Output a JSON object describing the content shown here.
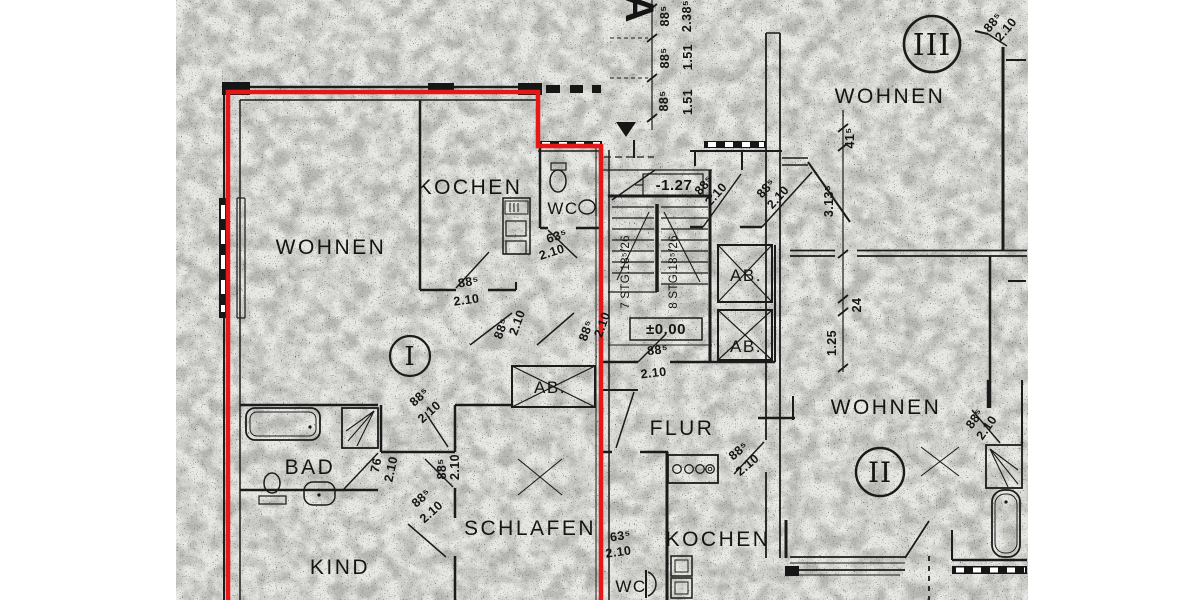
{
  "title": "scanned-floor-plan",
  "colors": {
    "highlight": "#e51717",
    "ink": "#1b1b1b",
    "paper": "#e7e7e4"
  },
  "rooms": {
    "wohnen1": "WOHNEN",
    "kochen1": "KOCHEN",
    "wc1": "WC",
    "bad": "BAD",
    "kind": "KIND",
    "schlafen": "SCHLAFEN",
    "flur": "FLUR",
    "kochen2": "KOCHEN",
    "wc2": "WC",
    "wohnen2": "WOHNEN",
    "wohnen3": "WOHNEN",
    "shaft": "AB."
  },
  "units": {
    "i": "I",
    "ii": "II",
    "iii": "III"
  },
  "marks": {
    "section": "A"
  },
  "levels": {
    "zero": "±0.00",
    "entry": "-1.27"
  },
  "stairs": {
    "left": "7 STG.18⁵/26",
    "right": "8 STG.18⁵/26"
  },
  "dims": {
    "d885": "88⁵",
    "d210": "2.10",
    "d635": "63⁵",
    "d151": "1.51",
    "d2385": "2.38⁵",
    "d76": "76",
    "d415": "41⁵",
    "d3135": "3.13⁵",
    "d24": "24",
    "d125": "1.25"
  }
}
